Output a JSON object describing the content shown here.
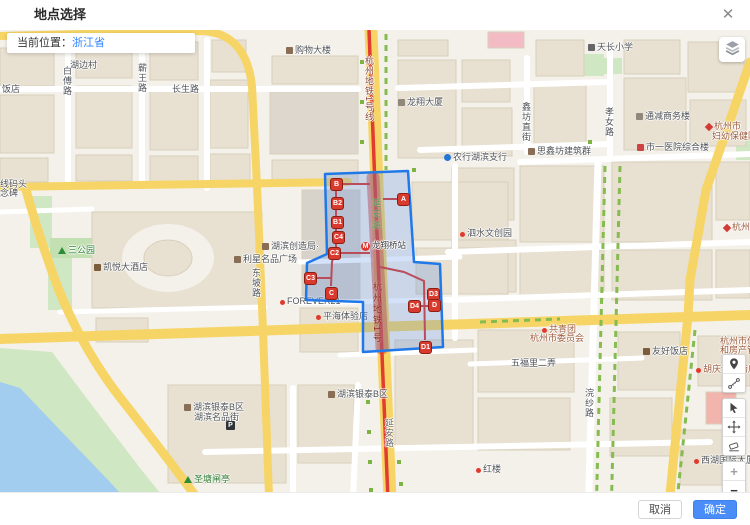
{
  "window": {
    "title": "地点选择",
    "close_glyph": "✕"
  },
  "info_bar": {
    "prefix": "当前位置：",
    "location": "浙江省"
  },
  "footer": {
    "cancel": "取消",
    "confirm": "确定",
    "confirm_color": "#4a8df8"
  },
  "controls": {
    "layers_icon": "map-layers-icon",
    "tools": [
      {
        "name": "location-pin-tool",
        "icon": "pin",
        "group": "a"
      },
      {
        "name": "measure-distance-tool",
        "icon": "measure",
        "group": "a"
      },
      {
        "name": "select-tool",
        "icon": "cursor",
        "group": "b"
      },
      {
        "name": "pan-tool",
        "icon": "move",
        "group": "b"
      },
      {
        "name": "eraser-tool",
        "icon": "eraser",
        "group": "b"
      },
      {
        "name": "zoom-in-button",
        "icon": "glyph",
        "glyph": "+",
        "dim": true,
        "group": "c"
      },
      {
        "name": "zoom-out-button",
        "icon": "glyph",
        "glyph": "−",
        "dim": false,
        "group": "c"
      }
    ]
  },
  "map": {
    "station": {
      "name": "龙翔桥站",
      "icon_letter": "M",
      "x": 361,
      "y": 239
    },
    "labels": [
      {
        "text": "饭店",
        "x": 2,
        "y": 84
      },
      {
        "text": "湖边村",
        "x": 70,
        "y": 60
      },
      {
        "text": "白傅路",
        "x": 62,
        "y": 66,
        "vertical": true
      },
      {
        "text": "蕲王路",
        "x": 137,
        "y": 63,
        "vertical": true
      },
      {
        "text": "长生路",
        "x": 172,
        "y": 84
      },
      {
        "text": "购物大楼",
        "x": 286,
        "y": 45,
        "icon": "bag"
      },
      {
        "text": "天长小学",
        "x": 588,
        "y": 42,
        "icon": "school"
      },
      {
        "text": "孝女路",
        "x": 604,
        "y": 107,
        "vertical": true
      },
      {
        "text": "通减商务楼",
        "x": 636,
        "y": 111,
        "icon": "building"
      },
      {
        "text": "杭州市",
        "x": 706,
        "y": 121,
        "icon": "diamond",
        "color": "#9c5a3c"
      },
      {
        "text": "妇幼保健院",
        "x": 712,
        "y": 131,
        "color": "#9c5a3c"
      },
      {
        "text": "市一医院综合楼",
        "x": 637,
        "y": 142,
        "icon": "hospital"
      },
      {
        "text": "鑫坊直街",
        "x": 521,
        "y": 102,
        "vertical": true
      },
      {
        "text": "思鑫坊建筑群",
        "x": 528,
        "y": 146,
        "icon": "gov"
      },
      {
        "text": "农行湖滨支行",
        "x": 444,
        "y": 152,
        "icon": "bank"
      },
      {
        "text": "龙翔大厦",
        "x": 398,
        "y": 97,
        "icon": "building"
      },
      {
        "text": "泗水文创园",
        "x": 460,
        "y": 228,
        "icon": "dot"
      },
      {
        "text": "杭州大药房",
        "x": 724,
        "y": 222,
        "icon": "diamond",
        "color": "#9c5a3c"
      },
      {
        "text": "三公园",
        "x": 58,
        "y": 245,
        "icon": "tree",
        "color": "#2e7d32"
      },
      {
        "text": "凯悦大酒店",
        "x": 94,
        "y": 262,
        "icon": "hotel"
      },
      {
        "text": "湖滨创造局·",
        "x": 262,
        "y": 241,
        "icon": "bag"
      },
      {
        "text": "利星名品广场",
        "x": 234,
        "y": 254,
        "icon": "bag"
      },
      {
        "text": "东坡路",
        "x": 251,
        "y": 268,
        "vertical": true
      },
      {
        "text": "FOREVER21",
        "x": 280,
        "y": 296,
        "icon": "dot"
      },
      {
        "text": "平海体验店",
        "x": 316,
        "y": 311,
        "icon": "dot"
      },
      {
        "text": "共青团",
        "x": 542,
        "y": 324,
        "icon": "dot",
        "color": "#9c5a3c"
      },
      {
        "text": "杭州市委员会",
        "x": 530,
        "y": 333,
        "color": "#9c5a3c"
      },
      {
        "text": "五福里二弄",
        "x": 511,
        "y": 358
      },
      {
        "text": "友好饭店",
        "x": 643,
        "y": 346,
        "icon": "hotel"
      },
      {
        "text": "浣纱路",
        "x": 584,
        "y": 388,
        "vertical": true
      },
      {
        "text": "胡庆余堂药店",
        "x": 696,
        "y": 364,
        "icon": "dot",
        "color": "#9c5a3c"
      },
      {
        "text": "杭州市住",
        "x": 720,
        "y": 336,
        "color": "#9c5a3c"
      },
      {
        "text": "和房产管",
        "x": 720,
        "y": 345,
        "color": "#9c5a3c"
      },
      {
        "text": "湖滨银泰B区",
        "x": 184,
        "y": 402,
        "icon": "bag"
      },
      {
        "text": "湖滨名品街",
        "x": 194,
        "y": 412
      },
      {
        "text": "",
        "x": 226,
        "y": 418,
        "icon": "parking"
      },
      {
        "text": "湖滨银泰B区",
        "x": 328,
        "y": 389,
        "icon": "bag"
      },
      {
        "text": "圣塘闸亭",
        "x": 184,
        "y": 474,
        "icon": "tree",
        "color": "#2e7d32"
      },
      {
        "text": "西湖国际大厦",
        "x": 694,
        "y": 455,
        "icon": "dot"
      },
      {
        "text": "红楼",
        "x": 476,
        "y": 464,
        "icon": "dot"
      },
      {
        "text": "线码头",
        "x": 0,
        "y": 179
      },
      {
        "text": "念碑",
        "x": 0,
        "y": 188
      },
      {
        "text": "杭州地铁1号线",
        "x": 364,
        "y": 56,
        "vertical": true,
        "color": "#8c4a3e"
      },
      {
        "text": "延安路",
        "x": 384,
        "y": 418,
        "vertical": true,
        "color": "#6a6a6a"
      }
    ]
  },
  "selection": {
    "polygon": "325,174 408,171 414,262 440,264 443,347 363,352 363,302 306,300 307,263 327,254",
    "fill": "rgba(78,134,230,0.25)",
    "stroke": "#2079e8",
    "band": {
      "x1": 373,
      "y1": 178,
      "x2": 382,
      "y2": 348,
      "color": "rgba(214,66,52,0.5)",
      "width": 13
    },
    "band_labels": [
      {
        "text": "延安路",
        "x": 370,
        "y": 198,
        "color": "#57a05a"
      },
      {
        "text": "杭州地铁1号",
        "x": 371,
        "y": 282,
        "color": "#8f2b20"
      }
    ],
    "routes": [
      "336,184 370,184",
      "336,184 336,248 332,262 331,286",
      "340,253 370,253",
      "310,278 331,278",
      "403,199 383,199",
      "380,267 404,272 424,281 425,340",
      "414,306 434,306",
      "433,295 433,305"
    ],
    "exits": [
      {
        "id": "B",
        "x": 336,
        "y": 184
      },
      {
        "id": "B2",
        "x": 337,
        "y": 203
      },
      {
        "id": "B1",
        "x": 337,
        "y": 222
      },
      {
        "id": "C4",
        "x": 338,
        "y": 237
      },
      {
        "id": "C2",
        "x": 334,
        "y": 253
      },
      {
        "id": "C3",
        "x": 310,
        "y": 278
      },
      {
        "id": "C",
        "x": 331,
        "y": 293
      },
      {
        "id": "A",
        "x": 403,
        "y": 199
      },
      {
        "id": "D3",
        "x": 433,
        "y": 294
      },
      {
        "id": "D",
        "x": 434,
        "y": 305
      },
      {
        "id": "D4",
        "x": 414,
        "y": 306
      },
      {
        "id": "D1",
        "x": 425,
        "y": 347
      }
    ]
  }
}
